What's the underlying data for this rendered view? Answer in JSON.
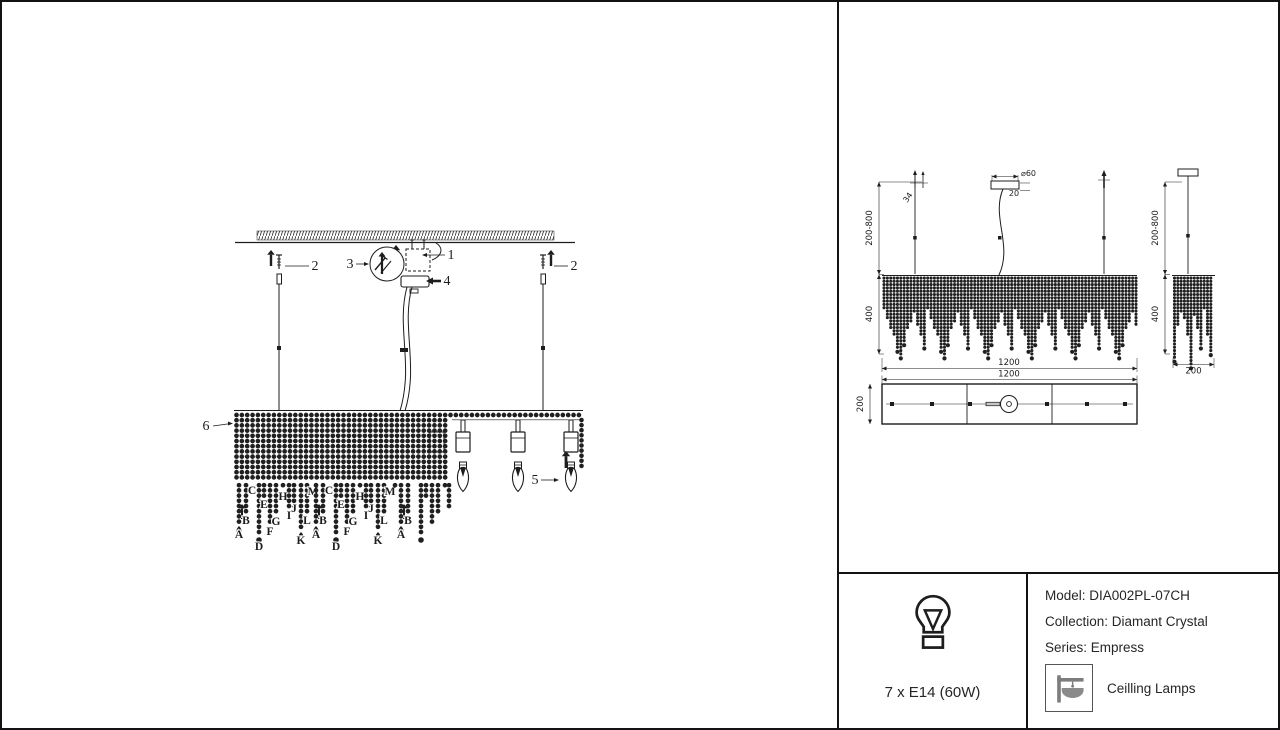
{
  "assembly": {
    "part_labels": {
      "p1": "1",
      "p2": "2",
      "p3": "3",
      "p4": "4",
      "p5": "5",
      "p6": "6"
    },
    "strand_letters": [
      "A",
      "B",
      "C",
      "D",
      "E",
      "F",
      "G",
      "H",
      "I",
      "J",
      "K",
      "L",
      "M"
    ]
  },
  "front_view": {
    "suspension_height": "200-800",
    "body_height": "400",
    "width": "1200",
    "canopy_diameter": "⌀60",
    "canopy_height": "20",
    "hanger_size": "34"
  },
  "side_view": {
    "suspension_height": "200-800",
    "body_height": "400",
    "depth": "200"
  },
  "plan_view": {
    "width": "1200",
    "depth": "200"
  },
  "spec_panel": {
    "bulb_spec": "7 x E14 (60W)",
    "model": "Model: DIA002PL-07CH",
    "collection": "Collection: Diamant Crystal",
    "series": "Series: Empress",
    "category": "Ceilling Lamps"
  },
  "colors": {
    "ink": "#1d1d1d",
    "bead": "#202020",
    "icon_gray": "#7d7d7d",
    "bowl_gray": "#8a8a8a"
  }
}
